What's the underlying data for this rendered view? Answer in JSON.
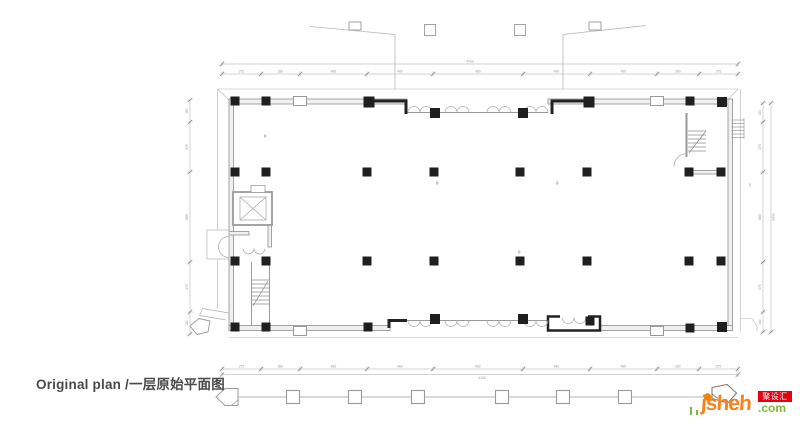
{
  "caption": {
    "text": "Original plan /一层原始平面图"
  },
  "logo": {
    "wordmark": "jsheh",
    "tld": ".com",
    "badge": "聚设汇",
    "colors": {
      "orange": "#f5821f",
      "green": "#7cb93e",
      "red": "#e60012"
    }
  },
  "plan": {
    "colors": {
      "wall_line": "#9a9a9a",
      "wall_fill": "#f0f0f0",
      "thin": "#b8b8b8",
      "solid": "#1f1f1f",
      "dim": "#c4c4c4",
      "dim_slash": "#8f8f8f",
      "dim_text": "#9c9c9c"
    },
    "column_size": 9,
    "columns": [
      [
        235,
        101
      ],
      [
        266,
        101
      ],
      [
        369,
        102,
        11
      ],
      [
        435,
        113,
        10
      ],
      [
        523,
        113,
        10
      ],
      [
        589,
        102,
        11
      ],
      [
        690,
        101
      ],
      [
        722,
        102,
        10
      ],
      [
        235,
        172
      ],
      [
        266,
        172
      ],
      [
        367,
        172
      ],
      [
        434,
        172
      ],
      [
        520,
        172
      ],
      [
        587,
        172
      ],
      [
        689,
        172
      ],
      [
        721,
        172
      ],
      [
        235,
        261
      ],
      [
        266,
        261
      ],
      [
        367,
        261
      ],
      [
        434,
        261
      ],
      [
        520,
        261
      ],
      [
        587,
        261
      ],
      [
        689,
        261
      ],
      [
        721,
        261
      ],
      [
        235,
        327
      ],
      [
        266,
        327
      ],
      [
        368,
        327
      ],
      [
        435,
        319,
        10
      ],
      [
        523,
        319,
        10
      ],
      [
        590,
        321
      ],
      [
        690,
        328
      ],
      [
        722,
        327,
        10
      ]
    ],
    "shaft_boxes": [
      [
        300,
        101
      ],
      [
        657,
        101
      ],
      [
        300,
        331
      ],
      [
        657,
        331
      ]
    ],
    "site_squares_bottom": {
      "y": 397,
      "size": 13,
      "x": [
        293,
        355,
        418,
        502,
        563,
        625
      ]
    },
    "site_squares_top": {
      "y": 30,
      "size": 11,
      "x": [
        430,
        520
      ]
    },
    "slant_brackets": [
      [
        355,
        26
      ],
      [
        595,
        26
      ]
    ],
    "dim_top": {
      "line_y": 74,
      "total_line_y": 64,
      "x1": 222,
      "x2": 738,
      "ticks": [
        222,
        261,
        300,
        367,
        433,
        523,
        590,
        657,
        699,
        738
      ],
      "labels": [
        "375",
        "380",
        "480",
        "480",
        "480",
        "480",
        "480",
        "380",
        "375"
      ],
      "total": "4430",
      "total_x": 470
    },
    "dim_bottom": {
      "line_y": 369,
      "total_line_y": 374.5,
      "x1": 222,
      "x2": 738,
      "ticks": [
        222,
        261,
        300,
        367,
        433,
        523,
        590,
        657,
        699,
        738
      ],
      "labels": [
        "375",
        "380",
        "480",
        "480",
        "480",
        "480",
        "480",
        "380",
        "375"
      ],
      "total": "4430",
      "total_x": 482
    },
    "dim_left": {
      "line_x": 190,
      "y1": 100,
      "y2": 334,
      "ticks": [
        100,
        122,
        172,
        262,
        312,
        334
      ],
      "labels": [
        "180",
        "375",
        "885",
        "375",
        "180"
      ]
    },
    "dim_right": {
      "line_x": 763,
      "y1": 103,
      "y2": 332,
      "ticks": [
        103,
        122,
        172,
        262,
        312,
        332
      ],
      "labels": [
        "180",
        "375",
        "885",
        "375",
        "180"
      ],
      "total": "2430",
      "total_line_x": 771,
      "total_y": 217
    }
  }
}
